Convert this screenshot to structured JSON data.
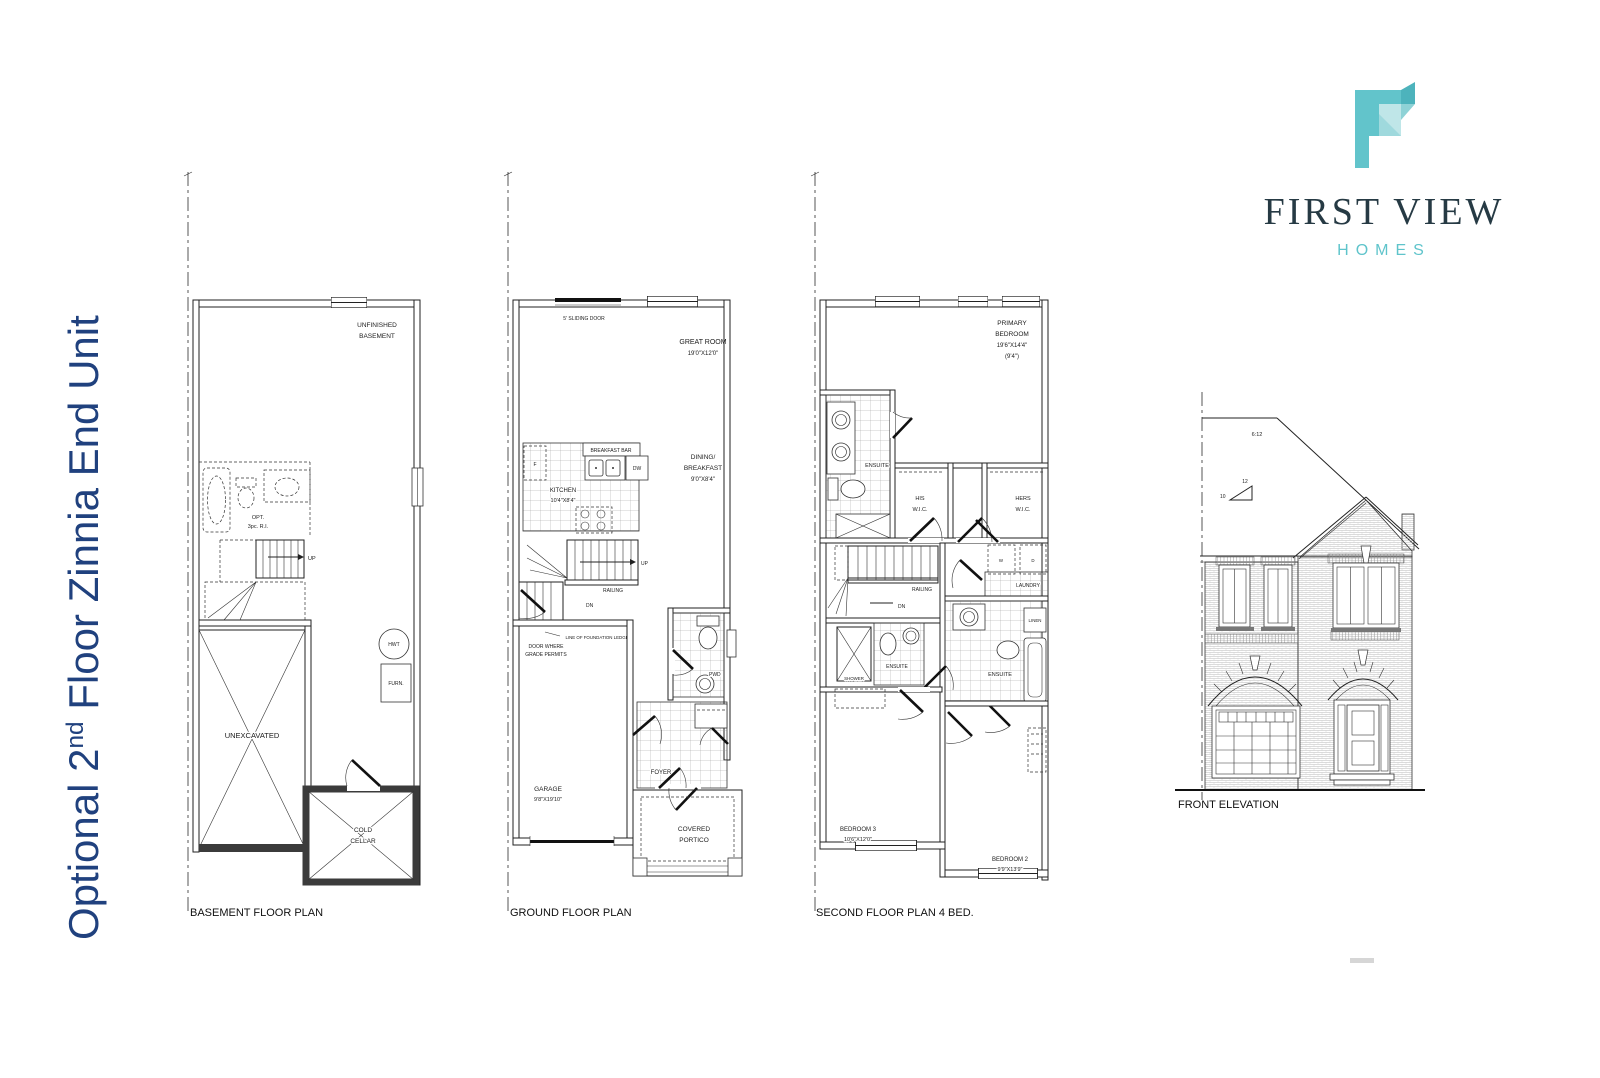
{
  "page": {
    "title_part1": "Optional 2",
    "title_sup": "nd",
    "title_part2": " Floor Zinnia End Unit"
  },
  "logo": {
    "line1": "FIRST VIEW",
    "line2": "HOMES"
  },
  "colors": {
    "title_blue": "#20417e",
    "logo_teal": "#5fc4cb",
    "logo_dark": "#263a44",
    "drawing_line": "#222222",
    "paper": "#ffffff"
  },
  "plans": {
    "basement": {
      "caption": "BASEMENT FLOOR PLAN",
      "labels": {
        "unfinished_l1": "UNFINISHED",
        "unfinished_l2": "BASEMENT",
        "opt_l1": "OPT.",
        "opt_l2": "3pc. R.I.",
        "up": "UP",
        "unexcavated": "UNEXCAVATED",
        "hwt": "HWT",
        "furn": "FURN.",
        "cold_l1": "COLD",
        "cold_l2": "CELLAR"
      }
    },
    "ground": {
      "caption": "GROUND FLOOR PLAN",
      "labels": {
        "sliding_door": "5' SLIDING DOOR",
        "great_room_l1": "GREAT ROOM",
        "great_room_l2": "19'0\"X12'0\"",
        "breakfast_bar": "BREAKFAST BAR",
        "fridge": "F",
        "dw": "DW",
        "kitchen_l1": "KITCHEN",
        "kitchen_l2": "10'4\"X8'4\"",
        "dining_l1": "DINING/",
        "dining_l2": "BREAKFAST",
        "dining_l3": "9'0\"X8'4\"",
        "up": "UP",
        "dn": "DN",
        "railing": "RAILING",
        "foundation_ledge": "LINE OF FOUNDATION LEDGE",
        "door_grade_l1": "DOOR WHERE",
        "door_grade_l2": "GRADE PERMITS",
        "pwd": "PWD",
        "garage_l1": "GARAGE",
        "garage_l2": "9'8\"X19'10\"",
        "foyer": "FOYER",
        "portico_l1": "COVERED",
        "portico_l2": "PORTICO"
      }
    },
    "second": {
      "caption": "SECOND FLOOR PLAN 4 BED.",
      "labels": {
        "primary_l1": "PRIMARY",
        "primary_l2": "BEDROOM",
        "primary_l3": "19'6\"X14'4\"",
        "primary_l4": "(9'4\")",
        "ensuite_primary": "ENSUITE",
        "his_l1": "HIS",
        "his_l2": "W.I.C.",
        "hers_l1": "HERS",
        "hers_l2": "W.I.C.",
        "railing": "RAILING",
        "dn": "DN",
        "washer": "W",
        "dryer": "D",
        "laundry": "LAUNDRY",
        "linen": "LINEN",
        "shower": "SHOWER",
        "ensuite_bed3": "ENSUITE",
        "ensuite_bed2": "ENSUITE",
        "bed3_l1": "BEDROOM 3",
        "bed3_l2": "10'6\"X12'0\"",
        "bed2_l1": "BEDROOM 2",
        "bed2_l2": "9'9\"X13'9\""
      }
    }
  },
  "elevation": {
    "caption": "FRONT ELEVATION",
    "slope_label": "6:12",
    "slope_rise": "12",
    "slope_run": "10"
  }
}
